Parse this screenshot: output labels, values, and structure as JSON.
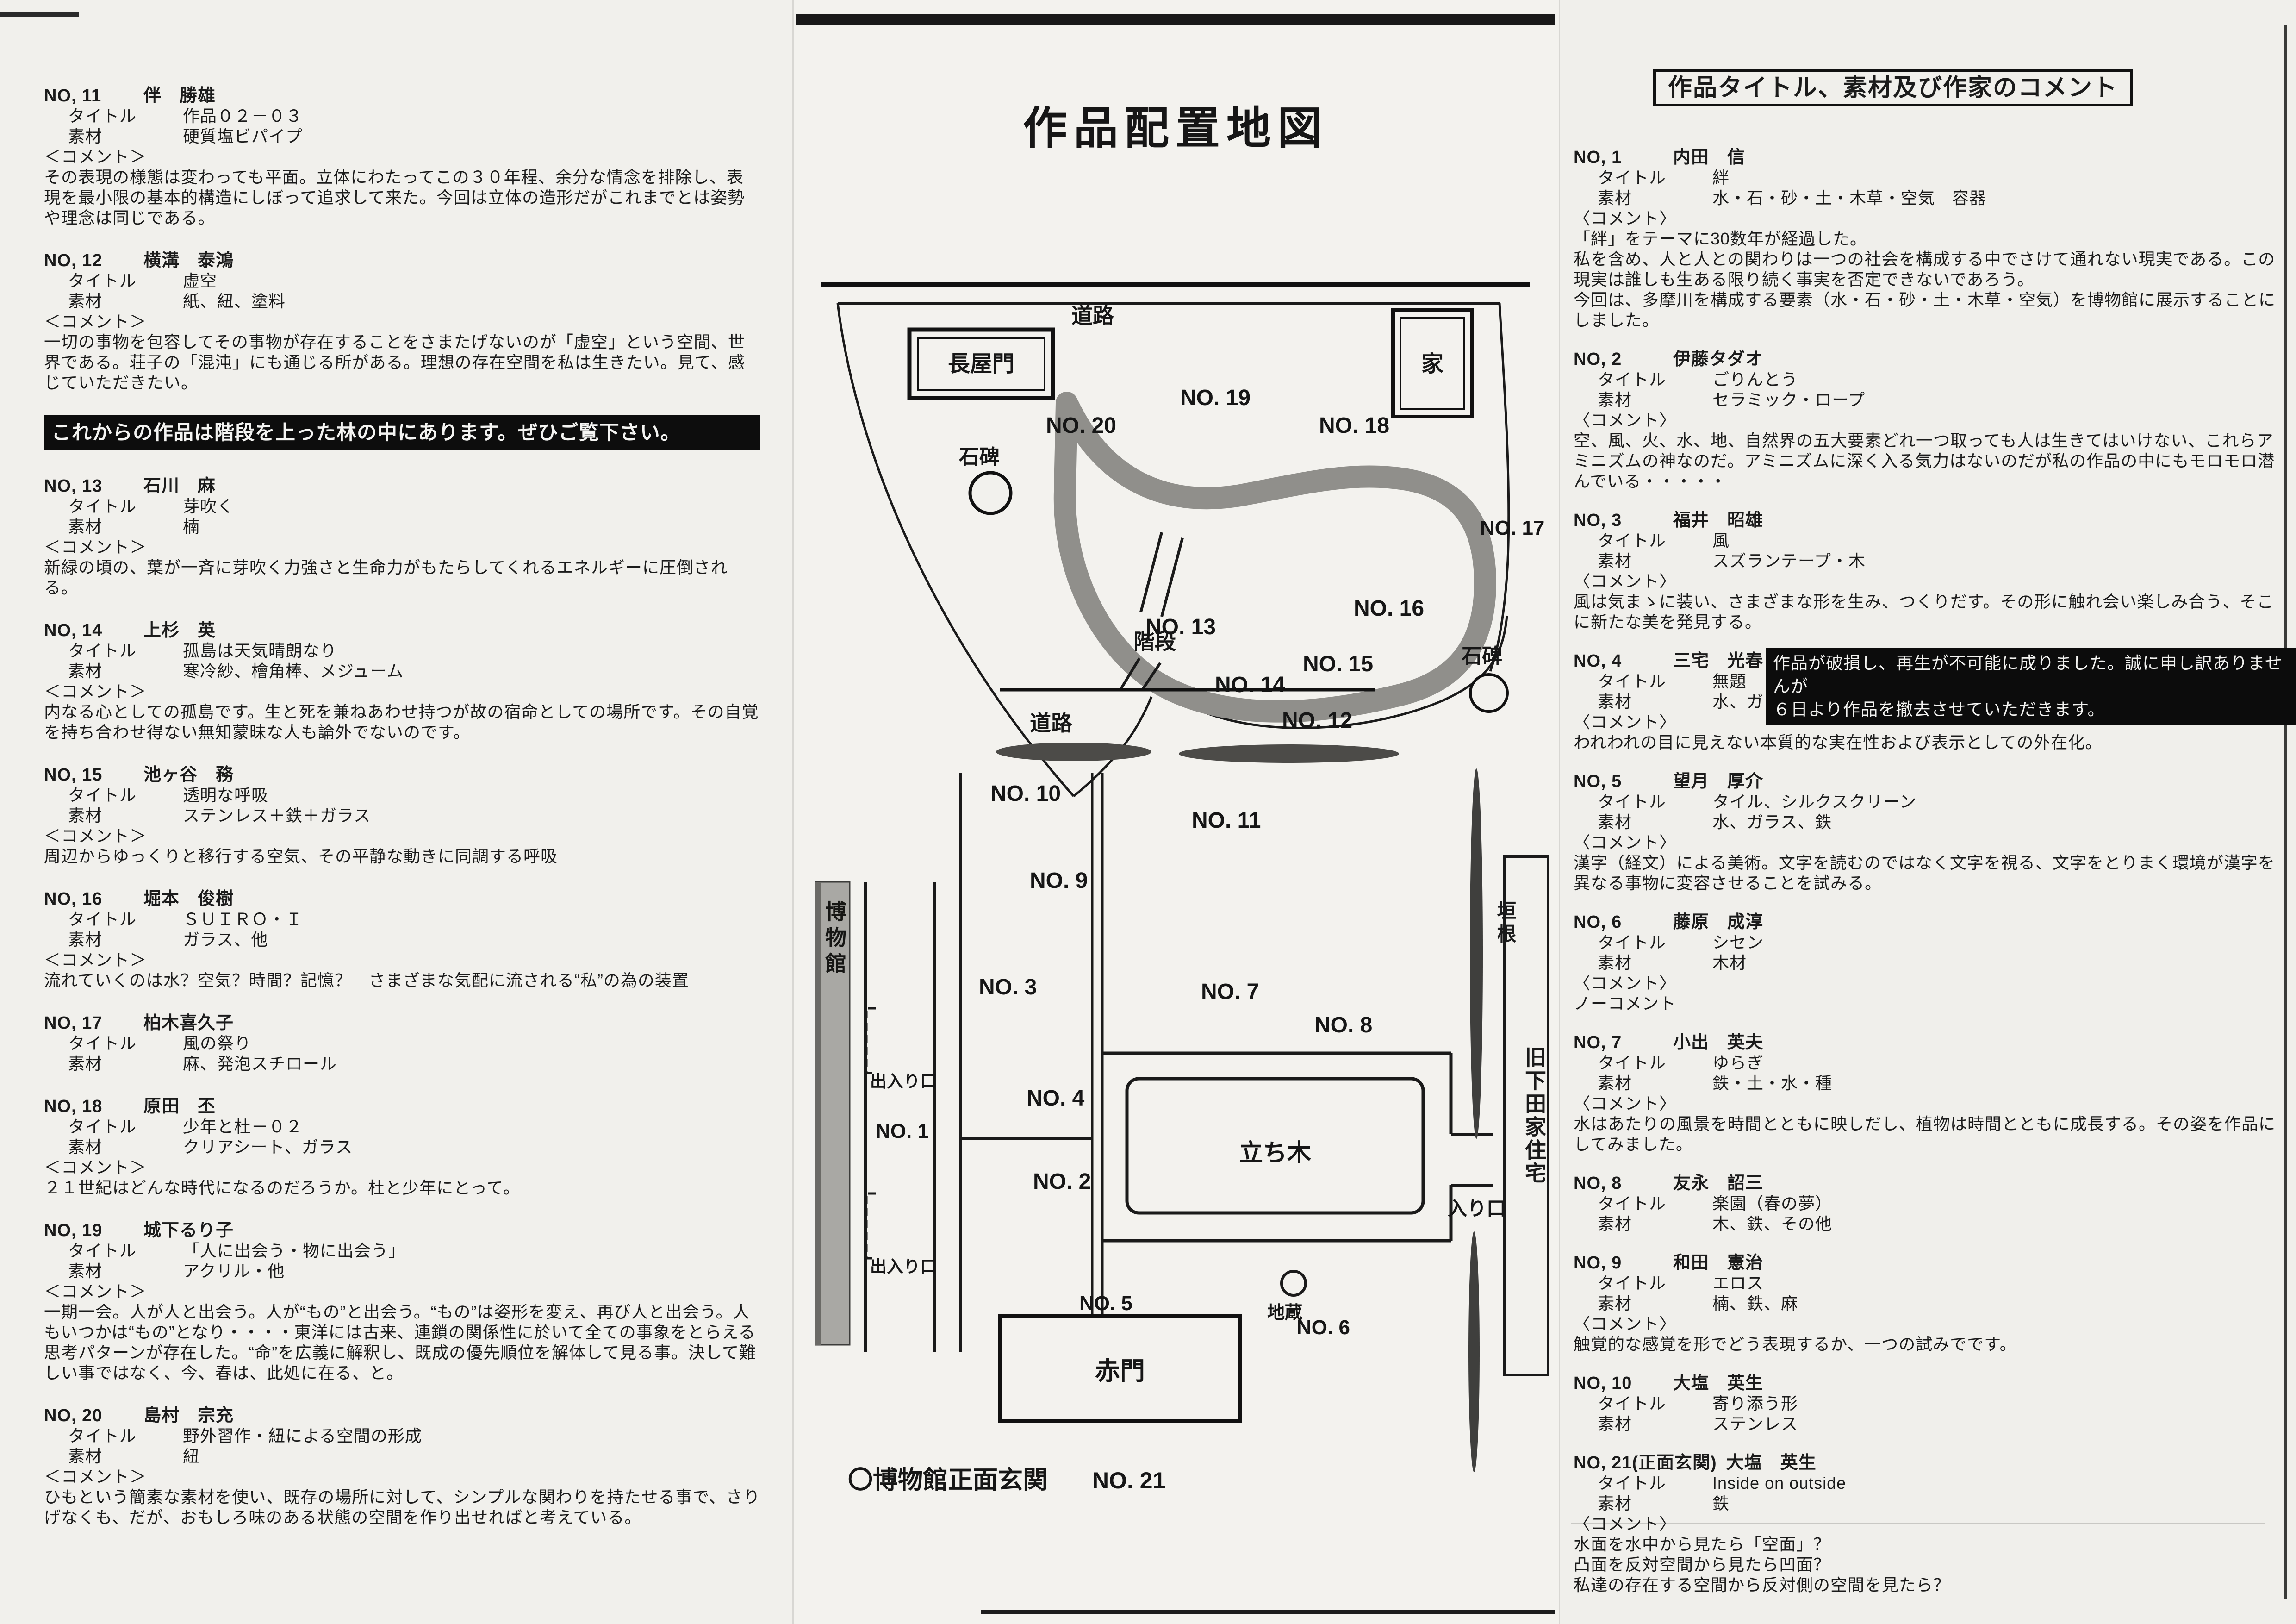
{
  "labels": {
    "title": "タイトル",
    "material": "素材",
    "comment_left": "＜コメント＞",
    "comment_right": "〈コメント〉"
  },
  "left_page": {
    "entries_top": [
      {
        "no": "NO, 11",
        "artist": "伴　勝雄",
        "title": "作品０２－０３",
        "material": "硬質塩ビパイプ",
        "comment": "その表現の様態は変わっても平面。立体にわたってこの３０年程、余分な情念を排除し、表現を最小限の基本的構造にしぼって追求して来た。今回は立体の造形だがこれまでとは姿勢や理念は同じである。"
      },
      {
        "no": "NO, 12",
        "artist": "横溝　泰鴻",
        "title": "虚空",
        "material": "紙、紐、塗料",
        "comment": "一切の事物を包容してその事物が存在することをさまたげないのが「虚空」という空間、世界である。荘子の「混沌」にも通じる所がある。理想の存在空間を私は生きたい。見て、感じていただきたい。"
      }
    ],
    "banner": "これからの作品は階段を上った林の中にあります。ぜひご覧下さい。",
    "entries_bottom": [
      {
        "no": "NO, 13",
        "artist": "石川　麻",
        "title": "芽吹く",
        "material": "楠",
        "comment": "新緑の頃の、葉が一斉に芽吹く力強さと生命力がもたらしてくれるエネルギーに圧倒される。"
      },
      {
        "no": "NO, 14",
        "artist": "上杉　英",
        "title": "孤島は天気晴朗なり",
        "material": "寒冷紗、檜角棒、メジューム",
        "comment": "内なる心としての孤島です。生と死を兼ねあわせ持つが故の宿命としての場所です。その自覚を持ち合わせ得ない無知蒙昧な人も論外でないのです。"
      },
      {
        "no": "NO, 15",
        "artist": "池ヶ谷　務",
        "title": "透明な呼吸",
        "material": "ステンレス＋鉄＋ガラス",
        "comment": "周辺からゆっくりと移行する空気、その平静な動きに同調する呼吸"
      },
      {
        "no": "NO, 16",
        "artist": "堀本　俊樹",
        "title": "ＳＵＩＲＯ・Ｉ",
        "material": "ガラス、他",
        "comment": "流れていくのは水？空気？時間？記憶？　さまざまな気配に流される“私”の為の装置"
      },
      {
        "no": "NO, 17",
        "artist": "柏木喜久子",
        "title": "風の祭り",
        "material": "麻、発泡スチロール",
        "comment": null
      },
      {
        "no": "NO, 18",
        "artist": "原田　丕",
        "title": "少年と杜－０２",
        "material": "クリアシート、ガラス",
        "comment": "２１世紀はどんな時代になるのだろうか。杜と少年にとって。"
      },
      {
        "no": "NO, 19",
        "artist": "城下るり子",
        "title": "「人に出会う・物に出会う」",
        "material": "アクリル・他",
        "comment": "一期一会。人が人と出会う。人が“もの”と出会う。“もの”は姿形を変え、再び人と出会う。人もいつかは“もの”となり・・・・東洋には古来、連鎖の関係性に於いて全ての事象をとらえる思考パターンが存在した。“命”を広義に解釈し、既成の優先順位を解体して見る事。決して難しい事ではなく、今、春は、此処に在る、と。"
      },
      {
        "no": "NO, 20",
        "artist": "島村　宗充",
        "title": "野外習作・紐による空間の形成",
        "material": "紐",
        "comment": "ひもという簡素な素材を使い、既存の場所に対して、シンプルな関わりを持たせる事で、さりげなくも、だが、おもしろ味のある状態の空間を作り出せればと考えている。"
      }
    ]
  },
  "right_page": {
    "header": "作品タイトル、素材及び作家のコメント",
    "entries": [
      {
        "no": "NO, 1",
        "artist": "内田　信",
        "title": "絆",
        "material": "水・石・砂・土・木草・空気　容器",
        "comment": "「絆」をテーマに30数年が経過した。\n私を含め、人と人との関わりは一つの社会を構成する中でさけて通れない現実である。この現実は誰しも生ある限り続く事実を否定できないであろう。\n今回は、多摩川を構成する要素（水・石・砂・土・木草・空気）を博物館に展示することにしました。"
      },
      {
        "no": "NO, 2",
        "artist": "伊藤タダオ",
        "title": "ごりんとう",
        "material": "セラミック・ロープ",
        "comment": "空、風、火、水、地、自然界の五大要素どれ一つ取っても人は生きてはいけない、これらアミニズムの神なのだ。アミニズムに深く入る気力はないのだが私の作品の中にもモロモロ潜んでいる・・・・・"
      },
      {
        "no": "NO, 3",
        "artist": "福井　昭雄",
        "title": "風",
        "material": "スズランテープ・木",
        "comment": "風は気まゝに装い、さまざまな形を生み、つくりだす。その形に触れ会い楽しみ合う、そこに新たな美を発見する。"
      },
      {
        "no": "NO, 4",
        "artist": "三宅　光春",
        "title": "無題",
        "material": "水、ガラス、鉄",
        "comment": "われわれの目に見えない本質的な実在性および表示としての外在化。",
        "notice_1": "作品が破損し、再生が不可能に成りました。誠に申し訳ありませんが",
        "notice_2": "６日より作品を撤去させていただきます。"
      },
      {
        "no": "NO, 5",
        "artist": "望月　厚介",
        "title": "タイル、シルクスクリーン",
        "material": "水、ガラス、鉄",
        "comment": "漢字（経文）による美術。文字を読むのではなく文字を視る、文字をとりまく環境が漢字を異なる事物に変容させることを試みる。"
      },
      {
        "no": "NO, 6",
        "artist": "藤原　成淳",
        "title": "シセン",
        "material": "木材",
        "comment": "ノーコメント"
      },
      {
        "no": "NO, 7",
        "artist": "小出　英夫",
        "title": "ゆらぎ",
        "material": "鉄・土・水・種",
        "comment": "水はあたりの風景を時間とともに映しだし、植物は時間とともに成長する。その姿を作品にしてみました。"
      },
      {
        "no": "NO, 8",
        "artist": "友永　詔三",
        "title": "楽園（春の夢）",
        "material": "木、鉄、その他",
        "comment": null
      },
      {
        "no": "NO, 9",
        "artist": "和田　憲治",
        "title": "エロス",
        "material": "楠、鉄、麻",
        "comment": "触覚的な感覚を形でどう表現するか、一つの試みでです。"
      },
      {
        "no": "NO, 10",
        "artist": "大塩　英生",
        "title": "寄り添う形",
        "material": "ステンレス",
        "comment": null
      },
      {
        "no": "NO, 21(正面玄関)",
        "artist": "大塩　英生",
        "title": "Inside on outside",
        "material": "鉄",
        "comment": "水面を水中から見たら「空面」？\n凸面を反対空間から見たら凹面？\n私達の存在する空間から反対側の空間を見たら？"
      }
    ]
  },
  "map": {
    "title": "作品配置地図",
    "road_top": "道路",
    "road_mid": "道路",
    "nagayamon": "長屋門",
    "house": "家",
    "sekihi_a": "石碑",
    "sekihi_b": "石碑",
    "kaidan": "階段",
    "museum": "博物館",
    "deiriguchi_a": "出入り口",
    "deiriguchi_b": "出入り口",
    "kakine": "垣根",
    "kyushimoda": "旧下田家住宅",
    "tachiki": "立ち木",
    "iriguchi": "入り口",
    "jizo": "地蔵",
    "akamon": "赤門",
    "footnote": "〇博物館正面玄関",
    "footnote_no": "NO. 21",
    "points": [
      "NO. 20",
      "NO. 19",
      "NO. 18",
      "NO. 17",
      "NO. 16",
      "NO. 15",
      "NO. 14",
      "NO. 13",
      "NO. 12",
      "NO. 10",
      "NO. 11",
      "NO. 9",
      "NO. 3",
      "NO. 7",
      "NO. 8",
      "NO. 4",
      "NO. 1",
      "NO. 2",
      "NO. 5",
      "NO. 6"
    ]
  }
}
